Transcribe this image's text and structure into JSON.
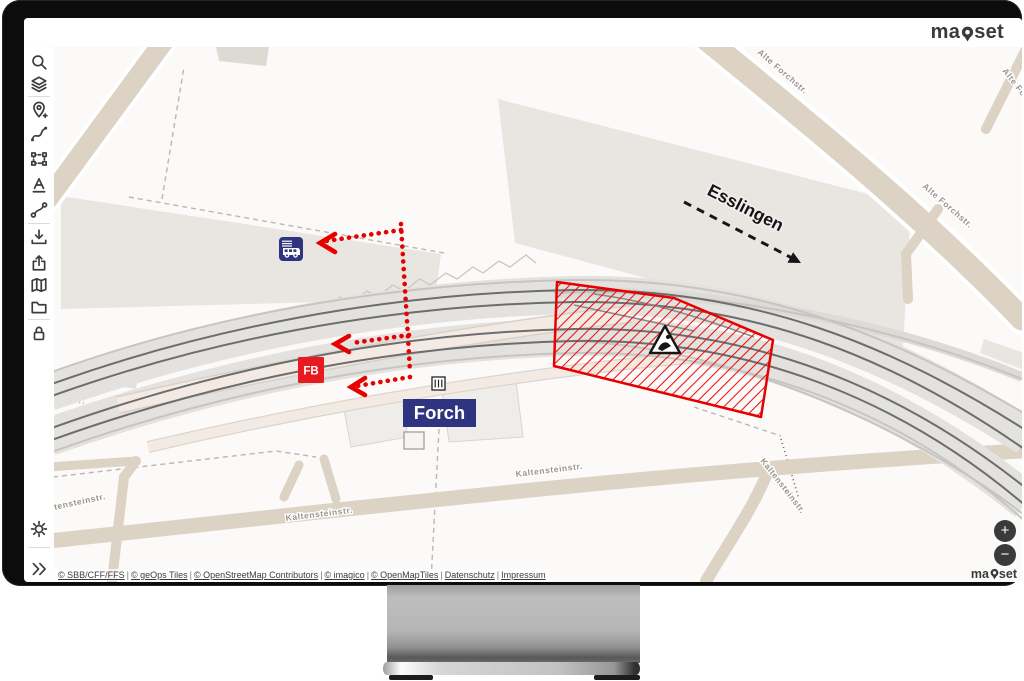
{
  "header": {
    "logo_prefix": "ma",
    "logo_suffix": "set"
  },
  "sidebar": {
    "icon_names": [
      "search",
      "layers",
      "add-location",
      "draw-line",
      "select-area",
      "text-tool",
      "connect-points",
      "download",
      "share",
      "map",
      "folder",
      "lock",
      "settings",
      "collapse"
    ]
  },
  "map": {
    "station_label": "Forch",
    "direction_label": "Esslingen",
    "fb_label": "FB",
    "street_labels": {
      "alte_forchstr": "Alte Forchstr.",
      "kaltensteinstr": "Kaltensteinstr."
    },
    "zoom_in": "+",
    "zoom_out": "−",
    "watermark_prefix": "ma",
    "watermark_suffix": "set"
  },
  "attribution": {
    "separator": "|",
    "items": [
      "© SBB/CFF/FFS",
      "© geOps Tiles",
      "© OpenStreetMap Contributors",
      "© imagico",
      "© OpenMapTiles",
      "Datenschutz",
      "Impressum"
    ]
  },
  "colors": {
    "accent_red": "#e60000",
    "sbb_red": "#e8191f",
    "dark_blue": "#2f3480",
    "road_beige": "#dcd3c5",
    "building_gray": "#e9e6e2"
  }
}
